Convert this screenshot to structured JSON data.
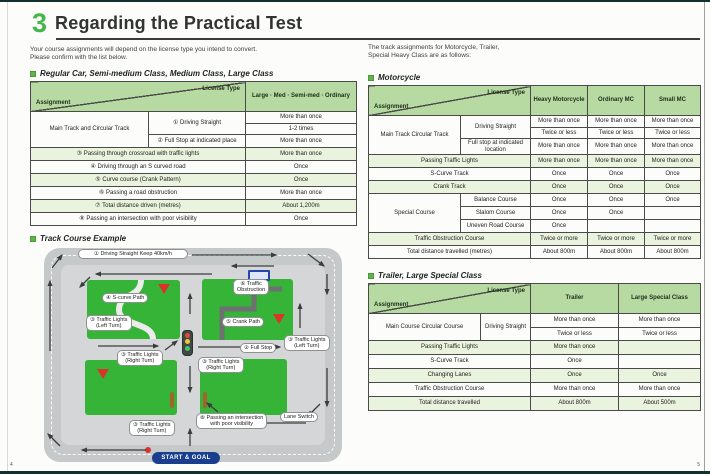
{
  "header": {
    "number": "3",
    "title": "Regarding the Practical Test"
  },
  "intro_left": {
    "line1": "Your course assignments will depend on the license type you intend to convert.",
    "line2": "Please confirm with the list below."
  },
  "intro_right": {
    "line1": "The track assignments for Motorcycle, Trailer,",
    "line2": "Special Heavy Class are as follows:"
  },
  "corner": {
    "license": "License Type",
    "assignment": "Assignment"
  },
  "regular": {
    "title": "Regular Car, Semi-medium Class, Medium Class, Large Class",
    "col_header": "Large · Med · Semi-med · Ordinary",
    "group": "Main Track and Circular Track",
    "row_straight": {
      "label": "① Driving Straight",
      "top": "More than once",
      "bottom": "1-2 times"
    },
    "row_fullstop": {
      "label": "② Full Stop at indicated place",
      "value": "More than once"
    },
    "rows": [
      {
        "label": "③ Passing through crossroad with traffic lights",
        "value": "More than once"
      },
      {
        "label": "④ Driving through an S curved road",
        "value": "Once"
      },
      {
        "label": "⑤ Curve course (Crank Pattern)",
        "value": "Once"
      },
      {
        "label": "⑥ Passing a road obstruction",
        "value": "More than once"
      },
      {
        "label": "⑦ Total distance driven  (metres)",
        "value": "About 1,200m"
      },
      {
        "label": "⑧ Passing an intersection with poor visibility",
        "value": "Once"
      }
    ]
  },
  "course": {
    "title": "Track Course Example",
    "labels": {
      "driving_straight": "① Driving Straight Keep 40km/h",
      "s_curve": "④ S-curve Path",
      "tl_left_a": "③ Traffic Lights\n(Left Turn)",
      "tl_right_a": "③ Traffic Lights\n(Right Turn)",
      "crank": "⑤ Crank Path",
      "full_stop": "② Full Stop",
      "tl_left_b": "③ Traffic Lights\n(Left Turn)",
      "tl_right_b": "③ Traffic Lights\n(Right Turn)",
      "obstruction": "⑥ Traffic\nObstruction",
      "poor_visibility": "⑧ Passing an intersection\nwith poor visibility",
      "lane_switch": "Lane Switch",
      "tl_right_c": "③ Traffic Lights\n(Right Turn)",
      "start_goal": "START & GOAL"
    }
  },
  "moto": {
    "title": "Motorcycle",
    "col_headers": [
      "Heavy Motorcycle",
      "Ordinary MC",
      "Small MC"
    ],
    "group_main": "Main Track Circular Track",
    "row_straight": {
      "label": "Driving Straight",
      "top": [
        "More than once",
        "More than once",
        "More than once"
      ],
      "bottom": [
        "Twice or less",
        "Twice or less",
        "Twice or less"
      ]
    },
    "row_fullstop": {
      "label": "Full stop at indicated location",
      "values": [
        "More than once",
        "More than once",
        "More than once"
      ]
    },
    "rows_mid": [
      {
        "label": "Passing Traffic Lights",
        "values": [
          "More than once",
          "More than once",
          "More than once"
        ]
      },
      {
        "label": "S-Curve Track",
        "values": [
          "Once",
          "Once",
          "Once"
        ]
      },
      {
        "label": "Crank Track",
        "values": [
          "Once",
          "Once",
          "Once"
        ]
      }
    ],
    "group_special": "Special Course",
    "rows_special": [
      {
        "label": "Balance Course",
        "values": [
          "Once",
          "Once",
          "Once"
        ]
      },
      {
        "label": "Slalom Course",
        "values": [
          "Once",
          "Once",
          ""
        ]
      },
      {
        "label": "Uneven Road Course",
        "values": [
          "Once",
          "",
          ""
        ]
      }
    ],
    "rows_bottom": [
      {
        "label": "Traffic Obstruction Course",
        "values": [
          "Twice or more",
          "Twice or more",
          "Twice or more"
        ]
      },
      {
        "label": "Total distance travelled  (metres)",
        "values": [
          "About 800m",
          "About 800m",
          "About 800m"
        ]
      }
    ]
  },
  "trailer": {
    "title": "Trailer, Large Special Class",
    "col_headers": [
      "Trailer",
      "Large Special Class"
    ],
    "group_main": "Main Course Circular Course",
    "row_straight": {
      "label": "Driving Straight",
      "top": [
        "More than once",
        "More than once"
      ],
      "bottom": [
        "Twice or less",
        "Twice or less"
      ]
    },
    "rows": [
      {
        "label": "Passing Traffic Lights",
        "values": [
          "More than once",
          ""
        ]
      },
      {
        "label": "S-Curve Track",
        "values": [
          "Once",
          ""
        ]
      },
      {
        "label": "Changing Lanes",
        "values": [
          "Once",
          "Once"
        ]
      },
      {
        "label": "Traffic Obstruction Course",
        "values": [
          "More than once",
          "More than once"
        ]
      },
      {
        "label": "Total distance travelled",
        "values": [
          "About 800m",
          "About 500m"
        ]
      }
    ]
  },
  "page_numbers": {
    "left": "4",
    "right": "5"
  }
}
